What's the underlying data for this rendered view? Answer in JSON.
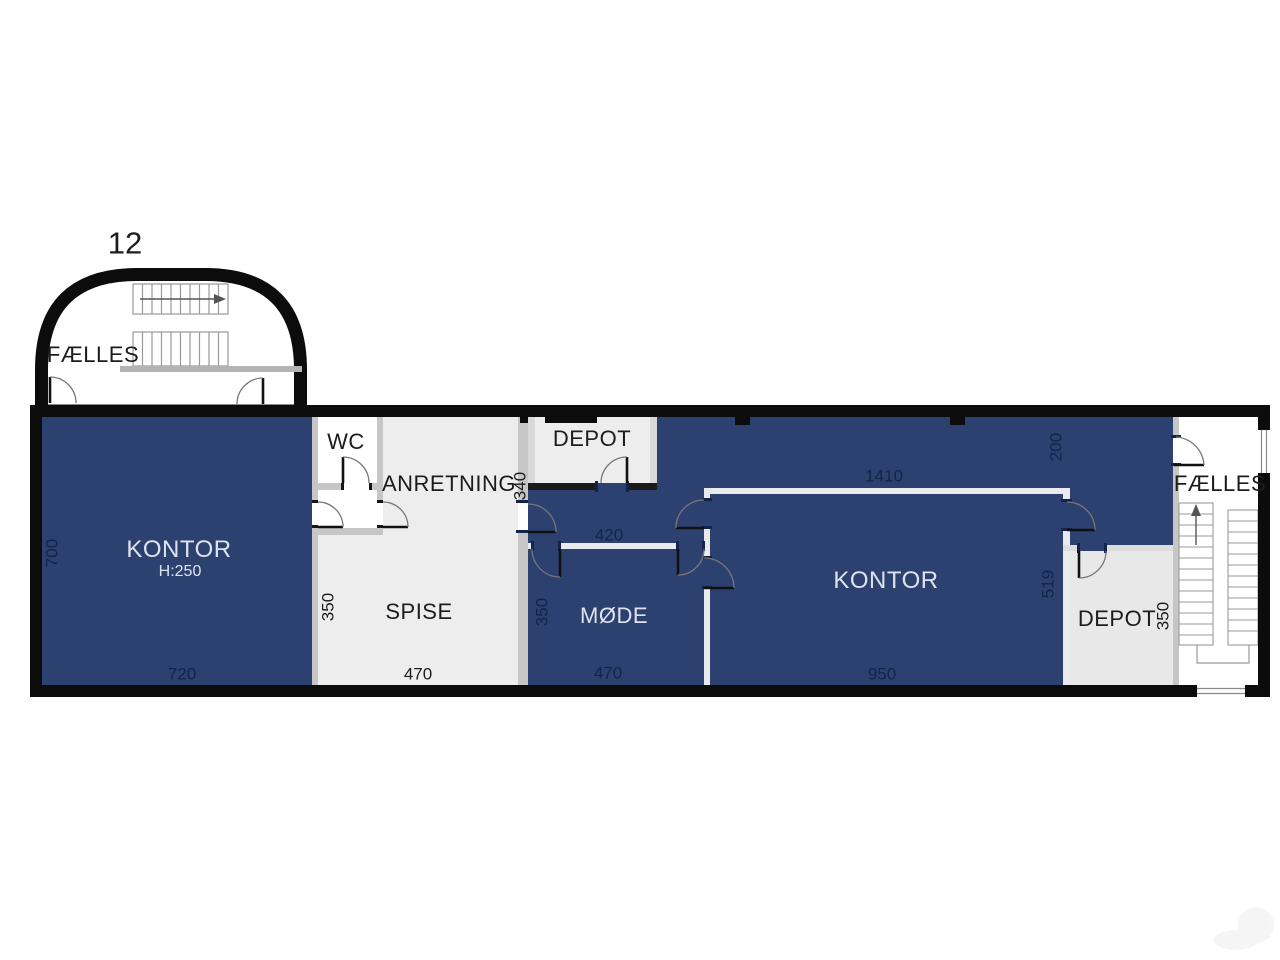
{
  "plan": {
    "floor_number": "12",
    "annex": {
      "label": "FÆLLES"
    },
    "kontor_left": {
      "label": "KONTOR",
      "height_note": "H:250",
      "dim_w": "720",
      "dim_h": "700"
    },
    "wc": {
      "label": "WC"
    },
    "anretning": {
      "label": "ANRETNING",
      "dim_h": "340"
    },
    "spise": {
      "label": "SPISE",
      "dim_w": "470",
      "dim_h": "350"
    },
    "depot_top": {
      "label": "DEPOT"
    },
    "corridor": {
      "dim_w": "420"
    },
    "moede": {
      "label": "MØDE",
      "dim_w": "470",
      "dim_h": "350"
    },
    "kontor_right": {
      "label": "KONTOR",
      "dim_w": "950",
      "dim_top": "1410",
      "dim_right": "519",
      "dim_corner": "200"
    },
    "depot_right": {
      "label": "DEPOT",
      "dim_h": "350"
    },
    "faelles_right": {
      "label": "FÆLLES"
    }
  },
  "colors": {
    "room_blue": "#2c4170",
    "room_gray": "#ededed",
    "depot_gray": "#e8e8e8",
    "wall_black": "#0c0c0c",
    "wall_gray": "#c6c6c6",
    "wall_white": "#e8eaee",
    "label_light": "#dde3ee",
    "dim_navy": "#13234a",
    "text_dark": "#1c1c1c"
  }
}
